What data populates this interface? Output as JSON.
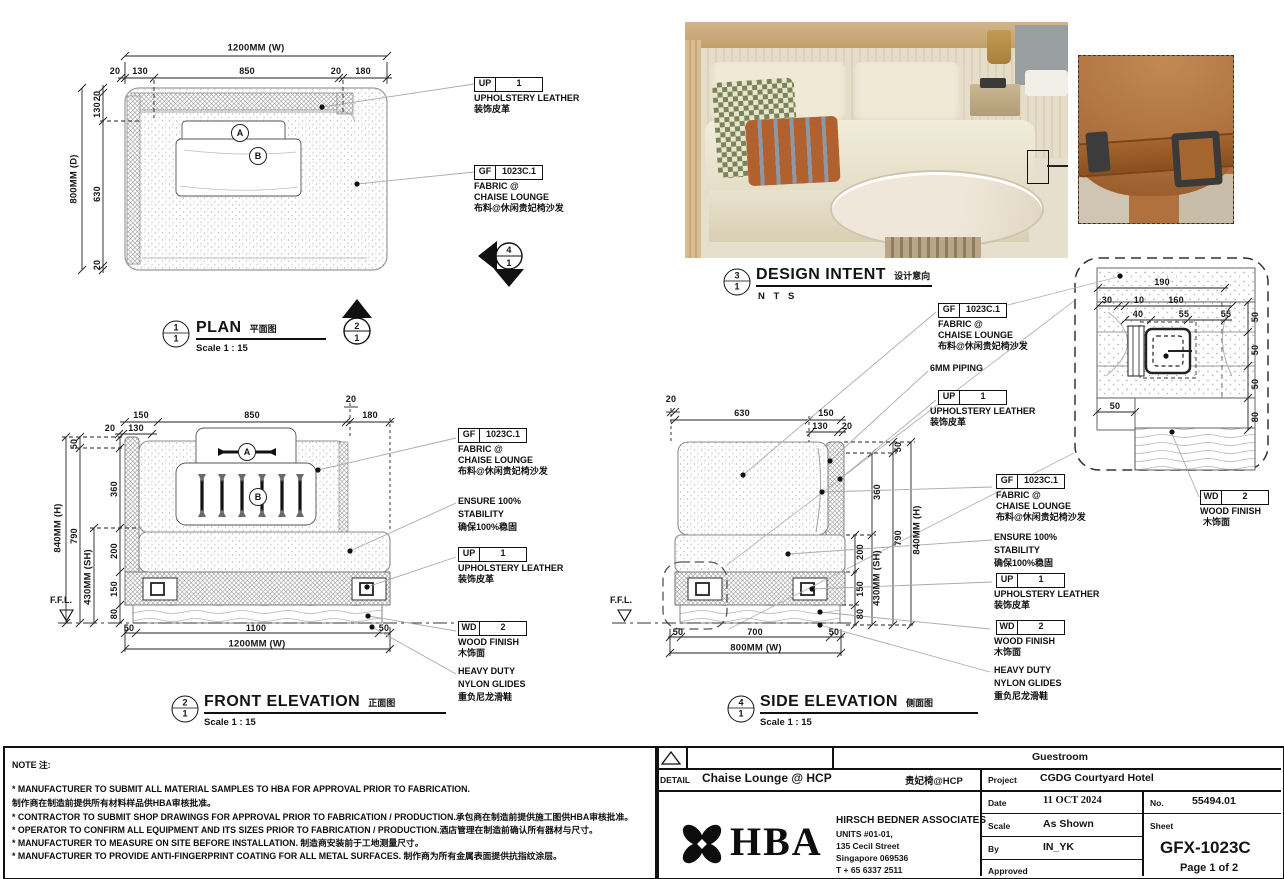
{
  "colors": {
    "line": "#141414",
    "leader": "#a8a8a8",
    "accent_wood": "#c9a876",
    "leather": "#b0713f"
  },
  "plan": {
    "marker_num": "1",
    "marker_ref": "1",
    "title": "PLAN",
    "title_cn": "平面图",
    "scale": "Scale 1 : 15",
    "overall_w": "1200MM (W)",
    "overall_d": "800MM (D)",
    "top": [
      "20",
      "130",
      "850",
      "20",
      "180"
    ],
    "left": [
      "20",
      "130",
      "630",
      "20"
    ],
    "pillow_a": "A",
    "pillow_b": "B"
  },
  "front": {
    "marker_num": "2",
    "marker_ref": "1",
    "title": "FRONT  ELEVATION",
    "title_cn": "正面图",
    "scale": "Scale 1 : 15",
    "overall_w": "1200MM (W)",
    "overall_h": "840MM (H)",
    "seat_h": "430MM (SH)",
    "top": [
      "150",
      "850",
      "20",
      "180",
      "20",
      "130"
    ],
    "left": [
      "50",
      "790",
      "360",
      "200",
      "150",
      "80"
    ],
    "bottom": [
      "50",
      "1100",
      "50"
    ],
    "pillow_a": "A",
    "pillow_b": "B"
  },
  "side": {
    "marker_num": "4",
    "marker_ref": "1",
    "title": "SIDE  ELEVATION",
    "title_cn": "侧面图",
    "scale": "Scale 1 : 15",
    "overall_w": "800MM (W)",
    "overall_h": "840MM (H)",
    "seat_h": "430MM (SH)",
    "top": [
      "20",
      "630",
      "150",
      "130",
      "20"
    ],
    "right": [
      "50",
      "360",
      "200",
      "150",
      "80",
      "790"
    ],
    "bottom": [
      "50",
      "700",
      "50"
    ]
  },
  "intent": {
    "marker_num": "3",
    "marker_ref": "1",
    "title": "DESIGN  INTENT",
    "title_cn": "设计意向",
    "scale": "N T S"
  },
  "detail": {
    "dims": [
      "190",
      "30",
      "10",
      "160",
      "40",
      "55",
      "55",
      "50",
      "50",
      "50",
      "80",
      "50"
    ]
  },
  "markers": {
    "sec2_top": "2",
    "sec2_bot": "1",
    "sec4_top": "4",
    "sec4_bot": "1"
  },
  "ffl_label": "F.F.L.",
  "callouts": {
    "up": {
      "code": "UP",
      "num": "1",
      "l1": "UPHOLSTERY LEATHER",
      "cn": "装饰皮革"
    },
    "gf": {
      "code": "GF",
      "num": "1023C.1",
      "l1": "FABRIC @",
      "l2": "CHAISE LOUNGE",
      "cn": "布料@休闲贵妃椅沙发"
    },
    "wd": {
      "code": "WD",
      "num": "2",
      "l1": "WOOD FINISH",
      "cn": "木饰面"
    },
    "stability": {
      "l1": "ENSURE 100%",
      "l2": "STABILITY",
      "cn": "确保100%稳固"
    },
    "glides": {
      "l1": "HEAVY DUTY",
      "l2": "NYLON GLIDES",
      "cn": "重负尼龙滑鞋"
    },
    "piping": {
      "l1": "6MM PIPING"
    }
  },
  "notes": {
    "heading": "NOTE 注:",
    "lines": [
      "* MANUFACTURER TO SUBMIT ALL MATERIAL SAMPLES TO HBA FOR APPROVAL PRIOR TO FABRICATION.",
      "制作商在制造前提供所有材料样品供HBA审核批准。",
      "* CONTRACTOR TO SUBMIT SHOP DRAWINGS FOR APPROVAL PRIOR TO FABRICATION / PRODUCTION.承包商在制造前提供施工图供HBA审核批准。",
      "* OPERATOR TO CONFIRM ALL EQUIPMENT AND ITS SIZES PRIOR TO FABRICATION / PRODUCTION.酒店管理在制造前确认所有器材与尺寸。",
      "* MANUFACTURER TO MEASURE ON SITE BEFORE INSTALLATION. 制造商安装前于工地测量尺寸。",
      "* MANUFACTURER TO PROVIDE ANTI-FINGERPRINT COATING FOR ALL METAL SURFACES. 制作商为所有金属表面提供抗指纹涂层。"
    ]
  },
  "titleblock": {
    "room": "Guestroom",
    "detail_label": "DETAIL",
    "detail_title": "Chaise Lounge @ HCP",
    "detail_title_cn": "贵妃椅@HCP",
    "project_label": "Project",
    "project": "CGDG Courtyard Hotel",
    "date_label": "Date",
    "date": "11 OCT 2024",
    "no_label": "No.",
    "no": "55494.01",
    "scale_label": "Scale",
    "scale": "As Shown",
    "sheet_label": "Sheet",
    "sheet_no": "GFX-1023C",
    "page": "Page 1 of 2",
    "by_label": "By",
    "by": "IN_YK",
    "approved_label": "Approved",
    "firm": {
      "logo_text": "HBA",
      "name": "HIRSCH BEDNER ASSOCIATES",
      "addr1": "UNITS #01-01,",
      "addr2": "135 Cecil Street",
      "addr3": "Singapore 069536",
      "addr4": "T + 65 6337 2511"
    }
  }
}
